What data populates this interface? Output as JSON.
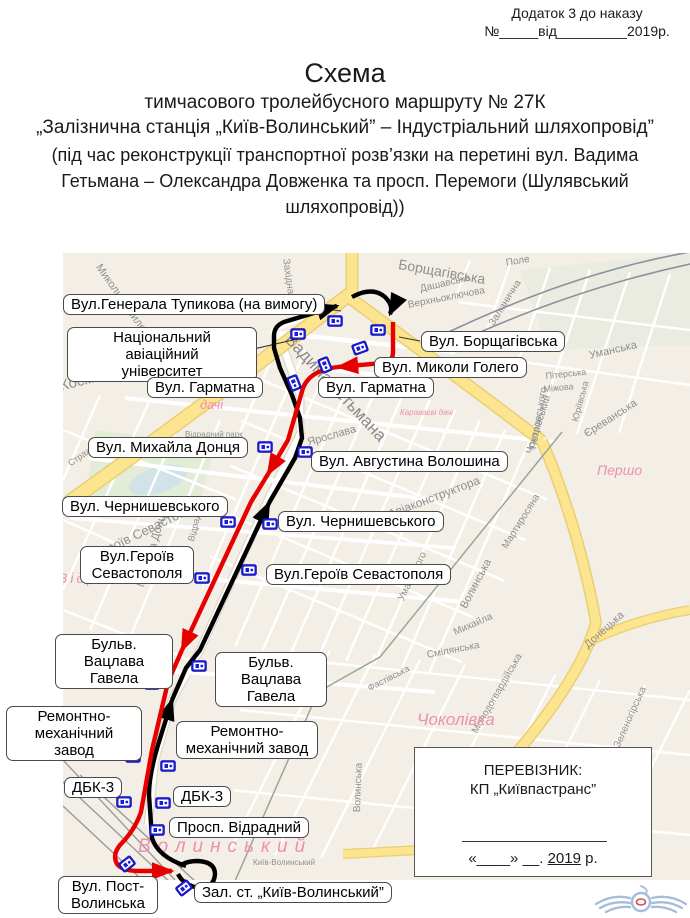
{
  "header": {
    "annex_line1": "Додаток 3 до наказу",
    "annex_line2": "№_____від_________2019р.",
    "title": "Схема",
    "subtitle1": "тимчасового тролейбусного маршруту  № 27К",
    "subtitle2": "„Залізнична  станція „Київ-Волинський” – Індустріальний шляхопровід”",
    "subtitle3": "(під час реконструкції транспортної розв’язки на перетині вул. Вадима Гетьмана – Олександра Довженка та просп. Перемоги (Шулявський шляхопровід))"
  },
  "map": {
    "colors": {
      "route_outbound_red": "#e60000",
      "route_return_black": "#000000",
      "stop_icon_blue": "#1c1cd6",
      "main_road_yellow": "#fce58e",
      "district_pink": "#ef8fb0"
    },
    "stop_labels": [
      {
        "text": "Вул.Генерала Тупикова (на вимогу)",
        "x": 63,
        "y": 294
      },
      {
        "text": "Національний авіаційний\nуніверситет",
        "x": 67,
        "y": 327,
        "w": 190
      },
      {
        "text": "Вул. Гарматна",
        "x": 147,
        "y": 377
      },
      {
        "text": "Вул. Борщагівська",
        "x": 421,
        "y": 331
      },
      {
        "text": "Вул. Миколи Голего",
        "x": 374,
        "y": 357
      },
      {
        "text": "Вул. Гарматна",
        "x": 318,
        "y": 377
      },
      {
        "text": "Вул. Михайла Донця",
        "x": 88,
        "y": 437
      },
      {
        "text": "Вул. Августина Волошина",
        "x": 311,
        "y": 451
      },
      {
        "text": "Вул. Чернишевського",
        "x": 62,
        "y": 496
      },
      {
        "text": "Вул. Чернишевського",
        "x": 278,
        "y": 511
      },
      {
        "text": "Вул.Героїв\nСевастополя",
        "x": 80,
        "y": 546,
        "w": 114
      },
      {
        "text": "Вул.Героїв Севастополя",
        "x": 266,
        "y": 564
      },
      {
        "text": "Бульв. Вацлава\nГавела",
        "x": 55,
        "y": 634,
        "w": 118
      },
      {
        "text": "Бульв. Вацлава\nГавела",
        "x": 215,
        "y": 652,
        "w": 112
      },
      {
        "text": "Ремонтно-\nмеханічний завод",
        "x": 6,
        "y": 706,
        "w": 136
      },
      {
        "text": "Ремонтно-\nмеханічний завод",
        "x": 176,
        "y": 721,
        "w": 142
      },
      {
        "text": "ДБК-3",
        "x": 64,
        "y": 777
      },
      {
        "text": "ДБК-3",
        "x": 173,
        "y": 786
      },
      {
        "text": "Просп. Відрадний",
        "x": 169,
        "y": 817
      },
      {
        "text": "Вул. Пост-\nВолинська",
        "x": 58,
        "y": 876,
        "w": 100
      },
      {
        "text": "Зал. ст. „Київ-Волинський”",
        "x": 194,
        "y": 882
      }
    ],
    "street_labels": [
      {
        "t": "Миколи Василенка",
        "x": 103,
        "y": 262,
        "r": 55,
        "s": 11
      },
      {
        "t": "Західна",
        "x": 291,
        "y": 258,
        "r": 82,
        "s": 10
      },
      {
        "t": "Космонавта Комарова",
        "x": 58,
        "y": 378,
        "r": -14,
        "s": 15
      },
      {
        "t": "Борщагівська",
        "x": 400,
        "y": 256,
        "r": 10,
        "s": 14
      },
      {
        "t": "Дашавська",
        "x": 419,
        "y": 284,
        "r": -13,
        "s": 10
      },
      {
        "t": "Верхньоключова",
        "x": 407,
        "y": 300,
        "r": -11,
        "s": 10
      },
      {
        "t": "Поле",
        "x": 505,
        "y": 258,
        "r": -10,
        "s": 10
      },
      {
        "t": "Залізнична",
        "x": 487,
        "y": 322,
        "r": -58,
        "s": 10
      },
      {
        "t": "Уманська",
        "x": 588,
        "y": 350,
        "r": -13,
        "s": 11
      },
      {
        "t": "Пітерська",
        "x": 545,
        "y": 371,
        "r": -6,
        "s": 9
      },
      {
        "t": "Міжова",
        "x": 543,
        "y": 384,
        "r": -5,
        "s": 9
      },
      {
        "t": "Єреванська",
        "x": 582,
        "y": 430,
        "r": -33,
        "s": 11
      },
      {
        "t": "Петровського",
        "x": 528,
        "y": 448,
        "r": -80,
        "s": 10
      },
      {
        "t": "Юріївська",
        "x": 570,
        "y": 420,
        "r": -75,
        "s": 9
      },
      {
        "t": "Ярослава",
        "x": 306,
        "y": 437,
        "r": -16,
        "s": 11
      },
      {
        "t": "Вадима Гетьмана",
        "x": 295,
        "y": 330,
        "r": 47,
        "s": 17,
        "c": "#8a8a8a"
      },
      {
        "t": "Авіаконструктора",
        "x": 386,
        "y": 508,
        "r": -21,
        "s": 12
      },
      {
        "t": "Чоколівський",
        "x": 524,
        "y": 452,
        "r": -72,
        "s": 10
      },
      {
        "t": "Мартиросяна",
        "x": 500,
        "y": 545,
        "r": -58,
        "s": 10
      },
      {
        "t": "Волинська",
        "x": 458,
        "y": 605,
        "r": -62,
        "s": 11
      },
      {
        "t": "Уманського",
        "x": 396,
        "y": 598,
        "r": -64,
        "s": 10
      },
      {
        "t": "Героїв Севастополя",
        "x": 92,
        "y": 548,
        "r": -26,
        "s": 13
      },
      {
        "t": "Михайла Донця",
        "x": 135,
        "y": 585,
        "r": -73,
        "s": 11
      },
      {
        "t": "Відрадний",
        "x": 186,
        "y": 540,
        "r": -76,
        "s": 9
      },
      {
        "t": "Стражеска",
        "x": 66,
        "y": 460,
        "r": -35,
        "s": 9
      },
      {
        "t": "Відрадний парк",
        "x": 185,
        "y": 430,
        "r": 0,
        "s": 8
      },
      {
        "t": "Смілянська",
        "x": 426,
        "y": 650,
        "r": -11,
        "s": 10
      },
      {
        "t": "Донецька",
        "x": 582,
        "y": 642,
        "r": -42,
        "s": 11
      },
      {
        "t": "Михайла",
        "x": 452,
        "y": 628,
        "r": -24,
        "s": 10
      },
      {
        "t": "Фастівська",
        "x": 366,
        "y": 684,
        "r": -27,
        "s": 9
      },
      {
        "t": "Молодогвардійська",
        "x": 470,
        "y": 730,
        "r": -60,
        "s": 10
      },
      {
        "t": "Волинська",
        "x": 352,
        "y": 812,
        "r": -88,
        "s": 10
      },
      {
        "t": "Зеленогірська",
        "x": 612,
        "y": 745,
        "r": -66,
        "s": 10
      },
      {
        "t": "Київ-Волинський",
        "x": 253,
        "y": 858,
        "r": 0,
        "s": 8
      },
      {
        "t": "Караваєві",
        "x": 183,
        "y": 383,
        "r": 0,
        "s": 13,
        "c": "#ef8fb0",
        "i": 1
      },
      {
        "t": "дачі",
        "x": 200,
        "y": 397,
        "r": 0,
        "s": 13,
        "c": "#ef8fb0",
        "i": 1
      },
      {
        "t": "Караваєві дачі",
        "x": 400,
        "y": 408,
        "r": 0,
        "s": 8,
        "c": "#ef8fb0",
        "i": 1
      },
      {
        "t": "Чоколівка",
        "x": 417,
        "y": 710,
        "r": 0,
        "s": 17,
        "c": "#ef8fb0",
        "i": 1
      },
      {
        "t": "Волинський",
        "x": 138,
        "y": 836,
        "r": 0,
        "s": 19,
        "c": "#ef8fb0",
        "i": 1,
        "ls": 7
      },
      {
        "t": "Першо",
        "x": 597,
        "y": 462,
        "r": 0,
        "s": 14,
        "c": "#ef8fb0",
        "i": 1
      },
      {
        "t": "Відра",
        "x": 58,
        "y": 570,
        "r": 0,
        "s": 14,
        "c": "#ef8fb0",
        "i": 1,
        "ls": 3
      }
    ],
    "stops": [
      [
        298,
        334,
        0
      ],
      [
        335,
        321,
        0
      ],
      [
        378,
        330,
        0
      ],
      [
        360,
        348,
        -20
      ],
      [
        325,
        365,
        68
      ],
      [
        294,
        383,
        68
      ],
      [
        265,
        447,
        0
      ],
      [
        305,
        452,
        0
      ],
      [
        228,
        522,
        0
      ],
      [
        270,
        524,
        0
      ],
      [
        202,
        578,
        0
      ],
      [
        249,
        570,
        0
      ],
      [
        199,
        666,
        0
      ],
      [
        152,
        684,
        0
      ],
      [
        133,
        757,
        0
      ],
      [
        168,
        766,
        0
      ],
      [
        124,
        802,
        0
      ],
      [
        163,
        803,
        0
      ],
      [
        157,
        830,
        0
      ],
      [
        127,
        864,
        -38
      ],
      [
        184,
        888,
        -38
      ]
    ]
  },
  "carrier_box": {
    "line1": "ПЕРЕВІЗНИК:",
    "line2": "КП „Київпастранс”",
    "date_prefix": "«____»  __. ",
    "date_year": "2019",
    "date_suffix": " р."
  }
}
